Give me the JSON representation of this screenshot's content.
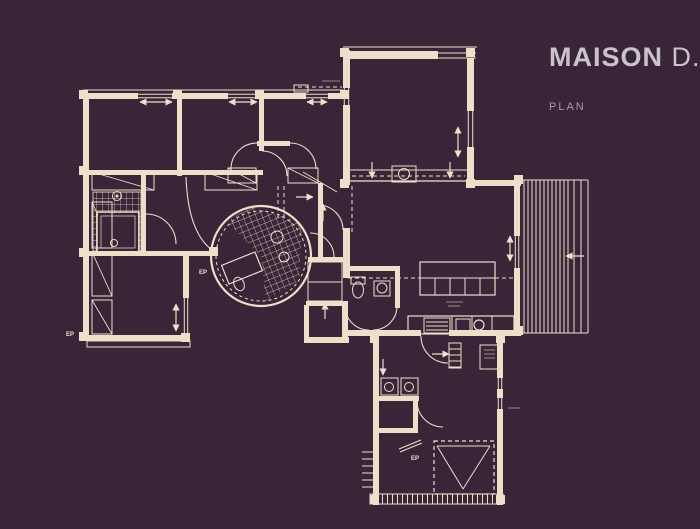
{
  "title": {
    "main": "MAISON",
    "suffix": " D.",
    "subtitle": "PLAN"
  },
  "colors": {
    "background": "#3a2438",
    "line": "#ece0ca",
    "dim": "#b7a898",
    "title": "#c9c4ca",
    "subtitle": "#a59da6"
  },
  "canvas": {
    "width": 700,
    "height": 529
  },
  "plan": {
    "labels_note": "EP = rainwater downpipe marks on plan",
    "hatches": [
      {
        "type": "rect",
        "x": 93,
        "y": 192,
        "w": 48,
        "h": 59
      },
      {
        "type": "poly",
        "points": "261,256 226,221 252,207 302,223 299,280 266,301",
        "rot": 1
      }
    ],
    "deck": {
      "xs": [
        524,
        528,
        532,
        536,
        540,
        544,
        548,
        552,
        556,
        560,
        564,
        568,
        574,
        581
      ],
      "y1": 180,
      "y2": 333
    },
    "bg_rects": [
      [
        98,
        213,
        40,
        38
      ]
    ],
    "walls": [
      [
        83,
        93,
        265,
        6
      ],
      [
        83,
        93,
        6,
        248
      ],
      [
        83,
        335,
        106,
        6
      ],
      [
        183,
        256,
        6,
        85
      ],
      [
        177,
        96,
        5,
        80
      ],
      [
        259,
        96,
        5,
        55
      ],
      [
        89,
        170,
        174,
        5
      ],
      [
        89,
        251,
        126,
        5
      ],
      [
        141,
        175,
        5,
        78
      ],
      [
        257,
        141,
        33,
        5
      ],
      [
        308,
        257,
        38,
        5
      ],
      [
        306,
        301,
        42,
        5
      ],
      [
        304,
        305,
        5,
        38
      ],
      [
        304,
        337,
        45,
        6
      ],
      [
        343,
        228,
        7,
        50
      ],
      [
        342,
        306,
        6,
        36
      ],
      [
        343,
        50,
        7,
        40
      ],
      [
        343,
        103,
        7,
        82
      ],
      [
        345,
        51,
        93,
        8
      ],
      [
        467,
        58,
        7,
        56
      ],
      [
        467,
        145,
        7,
        40
      ],
      [
        318,
        183,
        5,
        76
      ],
      [
        467,
        180,
        54,
        6
      ],
      [
        514,
        180,
        6,
        58
      ],
      [
        514,
        266,
        6,
        66
      ],
      [
        345,
        330,
        76,
        6
      ],
      [
        449,
        330,
        72,
        6
      ],
      [
        345,
        266,
        53,
        5
      ],
      [
        395,
        266,
        5,
        42
      ],
      [
        373,
        340,
        6,
        165
      ],
      [
        497,
        340,
        6,
        165
      ],
      [
        377,
        396,
        42,
        5
      ],
      [
        413,
        396,
        5,
        37
      ],
      [
        377,
        428,
        40,
        5
      ]
    ],
    "windows": [
      [
        138,
        93,
        34,
        6
      ],
      [
        228,
        93,
        30,
        6
      ],
      [
        306,
        93,
        22,
        6
      ],
      [
        183,
        298,
        6,
        36
      ],
      [
        343,
        88,
        7,
        17
      ],
      [
        467,
        111,
        7,
        36
      ],
      [
        514,
        236,
        6,
        32
      ],
      [
        497,
        378,
        6,
        11
      ],
      [
        497,
        398,
        6,
        11
      ]
    ],
    "posts": [
      [
        79,
        90
      ],
      [
        173,
        90
      ],
      [
        255,
        90
      ],
      [
        340,
        90
      ],
      [
        79,
        166
      ],
      [
        79,
        248
      ],
      [
        79,
        332
      ],
      [
        181,
        333
      ],
      [
        340,
        48
      ],
      [
        466,
        48
      ],
      [
        340,
        179
      ],
      [
        466,
        179
      ],
      [
        514,
        175
      ],
      [
        514,
        326
      ],
      [
        370,
        334
      ],
      [
        496,
        334
      ],
      [
        370,
        495
      ],
      [
        496,
        495
      ],
      [
        209,
        247
      ]
    ],
    "outlines": [
      [
        87,
        341,
        103,
        6,
        1
      ],
      [
        97,
        212,
        42,
        40,
        1.5
      ],
      [
        101,
        216,
        34,
        32,
        0.7
      ],
      [
        92,
        202,
        20,
        46,
        1
      ],
      [
        92,
        252,
        20,
        44,
        1
      ],
      [
        92,
        300,
        20,
        34,
        1
      ],
      [
        92,
        172,
        62,
        18,
        1
      ],
      [
        205,
        172,
        52,
        18,
        1
      ],
      [
        228,
        168,
        28,
        15,
        1
      ],
      [
        288,
        168,
        30,
        15,
        1
      ],
      [
        420,
        262,
        75,
        33,
        1.2
      ],
      [
        408,
        316,
        106,
        18,
        1.2
      ],
      [
        424,
        318,
        26,
        15,
        1
      ],
      [
        456,
        319,
        14,
        13,
        1
      ],
      [
        374,
        281,
        16,
        15,
        1
      ],
      [
        351,
        277,
        14,
        7,
        1
      ],
      [
        381,
        378,
        17,
        17,
        1
      ],
      [
        401,
        378,
        17,
        17,
        1
      ],
      [
        449,
        343,
        12,
        25,
        1
      ],
      [
        480,
        345,
        20,
        24,
        1
      ],
      [
        392,
        166,
        24,
        16,
        1
      ],
      [
        294,
        85,
        14,
        7,
        1
      ],
      [
        308,
        262,
        34,
        39,
        1
      ],
      [
        224,
        258,
        36,
        20,
        1.2,
        -22
      ]
    ],
    "lines": [
      [
        438,
        53,
        476,
        53,
        1
      ],
      [
        438,
        58,
        476,
        58,
        1
      ],
      [
        350,
        170,
        467,
        170,
        1
      ],
      [
        350,
        181,
        467,
        181,
        1.2
      ],
      [
        83,
        90,
        348,
        90,
        1
      ],
      [
        343,
        47,
        477,
        47,
        1
      ],
      [
        522,
        180,
        588,
        180,
        1
      ],
      [
        522,
        333,
        588,
        333,
        1
      ],
      [
        588,
        180,
        588,
        333,
        1
      ],
      [
        420,
        278,
        495,
        278,
        1
      ],
      [
        435,
        278,
        435,
        295,
        1
      ],
      [
        450,
        278,
        450,
        295,
        1
      ],
      [
        465,
        278,
        465,
        295,
        1
      ],
      [
        480,
        278,
        480,
        295,
        1
      ],
      [
        452,
        316,
        452,
        334,
        1
      ],
      [
        472,
        316,
        472,
        334,
        1
      ],
      [
        492,
        316,
        492,
        334,
        1
      ],
      [
        426,
        322,
        448,
        322,
        1
      ],
      [
        426,
        326,
        448,
        326,
        1
      ],
      [
        426,
        330,
        448,
        330,
        1
      ],
      [
        449,
        349,
        461,
        349,
        1
      ],
      [
        449,
        355,
        461,
        355,
        1
      ],
      [
        449,
        361,
        461,
        361,
        1
      ],
      [
        449,
        367,
        461,
        367,
        1
      ],
      [
        437,
        446,
        463,
        489,
        1
      ],
      [
        490,
        446,
        463,
        489,
        1
      ],
      [
        437,
        446,
        490,
        446,
        1
      ],
      [
        362,
        452,
        374,
        452,
        1
      ],
      [
        362,
        459,
        374,
        459,
        1
      ],
      [
        362,
        466,
        374,
        466,
        1
      ],
      [
        362,
        473,
        374,
        473,
        1
      ],
      [
        362,
        480,
        374,
        480,
        1
      ],
      [
        362,
        487,
        374,
        487,
        1
      ],
      [
        399,
        449,
        421,
        440,
        1
      ],
      [
        400,
        452,
        422,
        443,
        1
      ],
      [
        303,
        172,
        337,
        192,
        1
      ],
      [
        308,
        282,
        342,
        282,
        1
      ],
      [
        92,
        202,
        112,
        248,
        0.9
      ],
      [
        92,
        252,
        112,
        296,
        0.9
      ],
      [
        92,
        300,
        112,
        334,
        0.9
      ],
      [
        92,
        172,
        154,
        190,
        0.9
      ],
      [
        205,
        172,
        257,
        190,
        0.9
      ],
      [
        228,
        168,
        256,
        183,
        0.9
      ],
      [
        288,
        168,
        318,
        183,
        0.9
      ]
    ],
    "dim_lines": [
      [
        446,
        302,
        463,
        302
      ],
      [
        448,
        306,
        460,
        306
      ],
      [
        484,
        350,
        495,
        350
      ],
      [
        484,
        354,
        495,
        354
      ],
      [
        484,
        358,
        495,
        358
      ],
      [
        508,
        408,
        520,
        408
      ],
      [
        322,
        81,
        340,
        81
      ]
    ],
    "dashed_lines": [
      [
        278,
        186,
        278,
        218
      ],
      [
        284,
        186,
        284,
        218
      ],
      [
        352,
        186,
        352,
        232
      ],
      [
        352,
        176,
        465,
        176
      ],
      [
        348,
        278,
        514,
        278
      ],
      [
        298,
        87,
        342,
        87
      ]
    ],
    "dashed_rects": [
      [
        434,
        441,
        60,
        53
      ]
    ],
    "circles": [
      [
        261,
        256,
        50,
        2.2,
        ""
      ],
      [
        261,
        256,
        45,
        1,
        "3 3"
      ],
      [
        117,
        196,
        4.5,
        1,
        ""
      ],
      [
        117,
        196,
        1.5,
        0,
        ""
      ],
      [
        114,
        243,
        3.5,
        1,
        ""
      ],
      [
        277,
        237,
        6,
        1,
        ""
      ],
      [
        284,
        257,
        5,
        1,
        ""
      ],
      [
        382,
        288,
        5,
        1,
        ""
      ],
      [
        404,
        174,
        5.5,
        1,
        ""
      ],
      [
        389,
        387,
        4.5,
        1,
        ""
      ],
      [
        409,
        387,
        4.5,
        1,
        ""
      ],
      [
        479,
        325,
        5,
        1.2,
        ""
      ]
    ],
    "ellipses": [
      [
        358,
        290,
        5.5,
        8,
        0
      ],
      [
        239,
        284,
        5,
        7,
        -25
      ]
    ],
    "paths": [
      "M 257 143 A 26 26 0 0 0 231 169",
      "M 290 143 A 26 26 0 0 1 316 169",
      "M 310 233 A 24 24 0 0 1 334 257",
      "M 343 230 A 25 25 0 0 0 318 205",
      "M 345 306 A 24 24 0 0 0 369 330",
      "M 397 306 A 24 24 0 0 1 373 330",
      "M 421 336 A 27 27 0 0 0 448 363",
      "M 417 401 A 26 26 0 0 0 443 427",
      "M 146 214 A 30 30 0 0 1 176 244",
      "M 262 151 A 25 25 0 0 1 287 176",
      "M 186 177 Q 188 232 212 250"
    ],
    "tick_bands": [
      [
        370,
        494,
        133,
        10
      ]
    ],
    "arrows": [
      [
        140,
        102,
        172,
        102,
        1
      ],
      [
        229,
        102,
        257,
        102,
        1
      ],
      [
        307,
        102,
        327,
        102,
        1
      ],
      [
        176,
        304,
        176,
        331,
        1
      ],
      [
        458,
        127,
        458,
        157,
        1
      ],
      [
        510,
        236,
        510,
        261,
        1
      ],
      [
        372,
        162,
        372,
        178,
        0
      ],
      [
        450,
        162,
        450,
        178,
        0
      ],
      [
        296,
        197,
        313,
        197,
        0
      ],
      [
        323,
        221,
        323,
        204,
        0
      ],
      [
        325,
        319,
        325,
        303,
        0
      ],
      [
        432,
        354,
        449,
        354,
        0
      ],
      [
        383,
        359,
        383,
        375,
        0
      ],
      [
        584,
        256,
        566,
        256,
        0
      ]
    ],
    "texts": [
      {
        "t": "EP",
        "x": 66,
        "y": 336
      },
      {
        "t": "EP",
        "x": 199,
        "y": 274
      },
      {
        "t": "EP",
        "x": 411,
        "y": 460
      }
    ]
  }
}
